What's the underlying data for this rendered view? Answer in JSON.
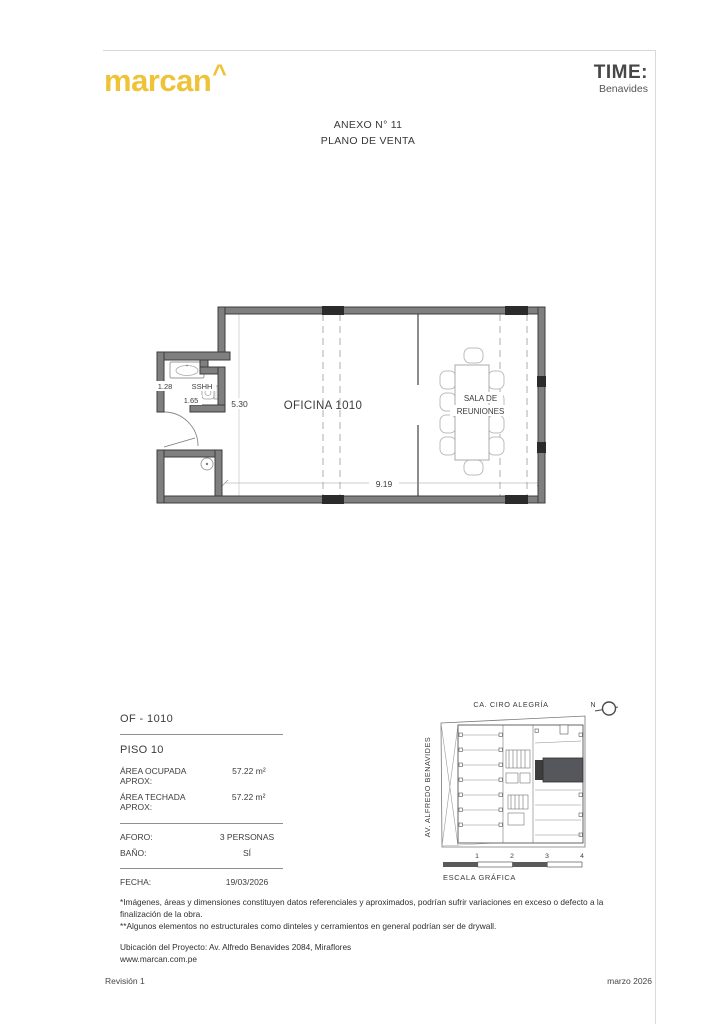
{
  "header": {
    "brand": "marcan",
    "brand_caret": "^",
    "partner_line1": "TIME:",
    "partner_line2": "Benavides"
  },
  "title": {
    "line1": "ANEXO N° 11",
    "line2": "PLANO DE VENTA"
  },
  "floor_plan": {
    "room_label": "OFICINA 1010",
    "meeting_room_line1": "SALA DE",
    "meeting_room_line2": "REUNIONES",
    "bathroom_label": "SSHH",
    "dim_width": "9.19",
    "dim_height": "5.30",
    "dim_bath_width": "1.28",
    "dim_bath_length": "1.65"
  },
  "info_panel": {
    "unit": "OF - 1010",
    "floor": "PISO 10",
    "areas": [
      {
        "label": "ÁREA OCUPADA APROX:",
        "value": "57.22 m²"
      },
      {
        "label": "ÁREA TECHADA APROX:",
        "value": "57.22 m²"
      }
    ],
    "capacity": [
      {
        "label": "AFORO:",
        "value": "3 PERSONAS"
      },
      {
        "label": "BAÑO:",
        "value": "SÍ"
      }
    ],
    "date": {
      "label": "FECHA:",
      "value": "19/03/2026"
    }
  },
  "key_plan": {
    "street_top": "CA. CIRO ALEGRÍA",
    "street_left": "AV. ALFREDO BENAVIDES",
    "north_label": "N",
    "scale_numbers": [
      "1",
      "2",
      "3",
      "4"
    ],
    "scale_label": "ESCALA GRÁFICA"
  },
  "notes": {
    "disclaimer1": "*Imágenes, áreas y dimensiones constituyen datos referenciales y aproximados, podrían sufrir variaciones en exceso o defecto a la finalización de la obra.",
    "disclaimer2": "**Algunos elementos no estructurales como dinteles y cerramientos en general podrían ser de drywall.",
    "location": "Ubicación del Proyecto: Av. Alfredo Benavides 2084, Miraflores",
    "website": "www.marcan.com.pe"
  },
  "footer": {
    "revision": "Revisión 1",
    "date": "marzo 2026"
  },
  "colors": {
    "brand_yellow": "#EFC337",
    "partner_gray": "#474747",
    "wall_gray": "#7f7f7f",
    "column_black": "#2b2b2b",
    "highlight_unit": "#56575c"
  }
}
